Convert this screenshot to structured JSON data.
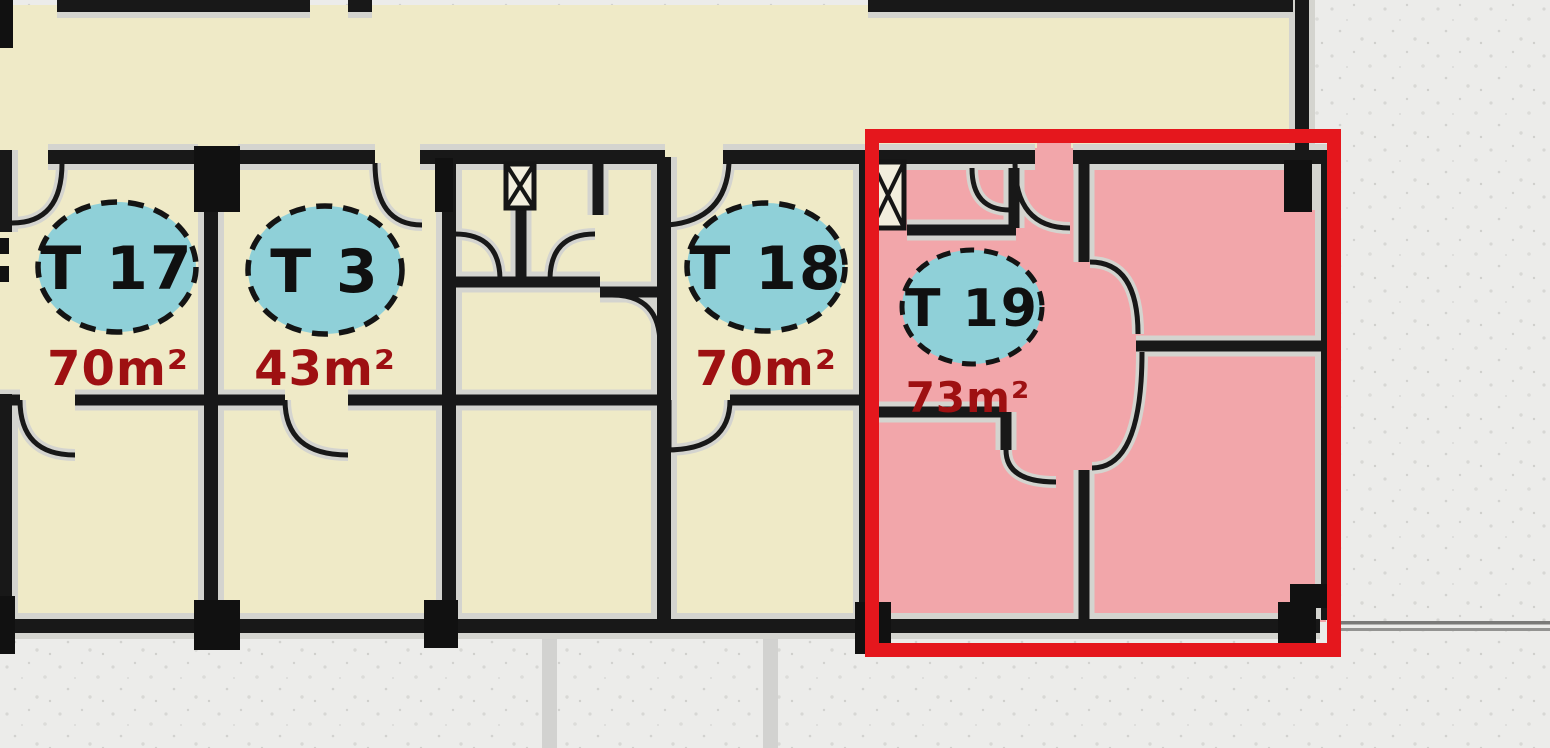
{
  "floor_plan": {
    "units": [
      {
        "badge": "T 17",
        "area": "70m²",
        "highlighted": false
      },
      {
        "badge": "T 3",
        "area": "43m²",
        "highlighted": false
      },
      {
        "badge": "T 18",
        "area": "70m²",
        "highlighted": false
      },
      {
        "badge": "T 19",
        "area": "73m²",
        "highlighted": true
      }
    ],
    "colors": {
      "background": "#ececea",
      "floor": "#efeac7",
      "highlight_floor": "#f2a6aa",
      "badge_fill": "#8fd0d8",
      "badge_border": "#141414",
      "area_text": "#9e1012",
      "wall": "#181818",
      "wall_halo": "#d4d4cf",
      "highlight_box": "#e5171d"
    }
  }
}
